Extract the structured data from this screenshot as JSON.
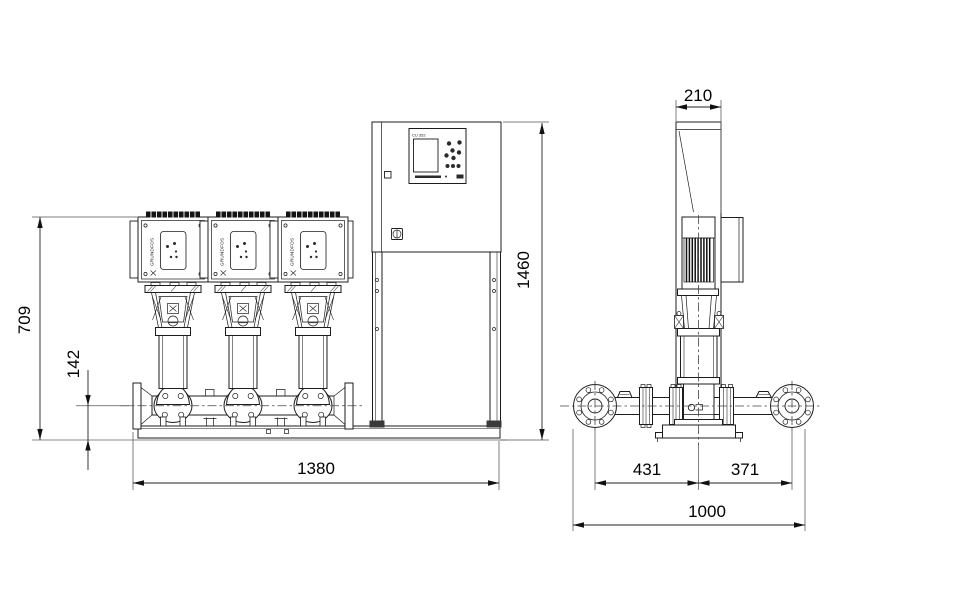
{
  "drawing": {
    "front_view": {
      "dim_pump_height": "709",
      "dim_manifold_height": "142",
      "dim_total_width": "1380",
      "dim_total_height": "1460",
      "cabinet_panel_label": "CU 352",
      "pump_brand": "GRUNDFOS"
    },
    "side_view": {
      "dim_cabinet_depth": "210",
      "dim_suction_offset": "431",
      "dim_discharge_offset": "371",
      "dim_base_depth": "1000"
    }
  }
}
